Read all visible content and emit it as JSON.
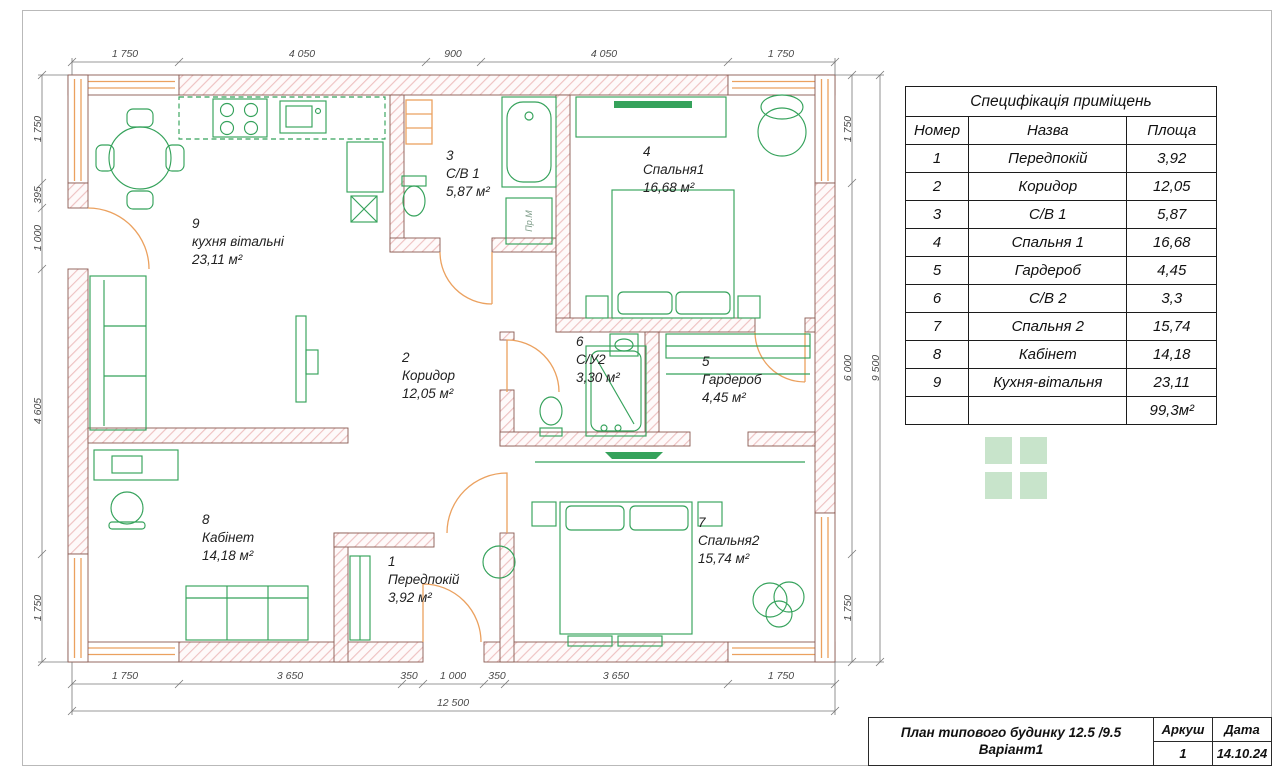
{
  "table": {
    "title": "Специфікація приміщень",
    "headers": [
      "Номер",
      "Назва",
      "Площа"
    ],
    "rows": [
      [
        "1",
        "Передпокій",
        "3,92"
      ],
      [
        "2",
        "Коридор",
        "12,05"
      ],
      [
        "3",
        "С/В 1",
        "5,87"
      ],
      [
        "4",
        "Спальня 1",
        "16,68"
      ],
      [
        "5",
        "Гардероб",
        "4,45"
      ],
      [
        "6",
        "С/В 2",
        "3,3"
      ],
      [
        "7",
        "Спальня 2",
        "15,74"
      ],
      [
        "8",
        "Кабінет",
        "14,18"
      ],
      [
        "9",
        "Кухня-вітальня",
        "23,11"
      ]
    ],
    "total_area": "99,3м²"
  },
  "titleblock": {
    "title_line1": "План типового будинку 12.5 /9.5",
    "title_line2": "Варіант1",
    "sheet_label": "Аркуш",
    "sheet_value": "1",
    "date_label": "Дата",
    "date_value": "14.10.24"
  },
  "rooms": {
    "kitchen": {
      "num": "9",
      "name": "кухня вітальні",
      "area": "23,11 м²"
    },
    "bath1": {
      "num": "3",
      "name": "С/В 1",
      "area": "5,87 м²"
    },
    "bedroom1": {
      "num": "4",
      "name": "Спальня1",
      "area": "16,68 м²"
    },
    "corridor": {
      "num": "2",
      "name": "Коридор",
      "area": "12,05 м²"
    },
    "bath2": {
      "num": "6",
      "name": "С/У2",
      "area": "3,30 м²"
    },
    "wardrobe": {
      "num": "5",
      "name": "Гардероб",
      "area": "4,45 м²"
    },
    "office": {
      "num": "8",
      "name": "Кабінет",
      "area": "14,18 м²"
    },
    "hall": {
      "num": "1",
      "name": "Передпокій",
      "area": "3,92 м²"
    },
    "bedroom2": {
      "num": "7",
      "name": "Спальня2",
      "area": "15,74 м²"
    }
  },
  "dims": {
    "top": [
      "1 750",
      "4 050",
      "900",
      "4 050",
      "1 750"
    ],
    "bottom": [
      "1 750",
      "3 650",
      "350",
      "1 000",
      "350",
      "3 650",
      "1 750"
    ],
    "bottom_total": "12 500",
    "left": [
      "1 750",
      "395",
      "1 000",
      "4 605",
      "1 750"
    ],
    "right": [
      "1 750",
      "6 000",
      "1 750"
    ],
    "right_total": "9 500"
  },
  "labels": {
    "washer": "Пр.М"
  },
  "colors": {
    "wall_hatch": "#eec2c2",
    "furniture": "#35a25b",
    "openings": "#eba15f",
    "logo_square": "#c8e4cb"
  }
}
